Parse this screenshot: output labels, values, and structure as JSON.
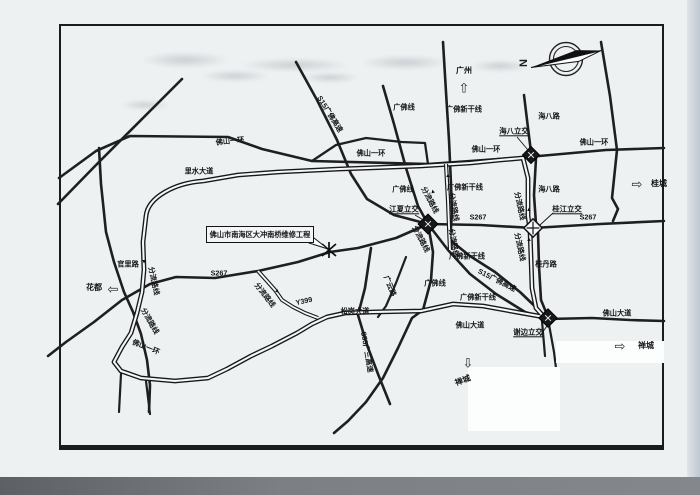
{
  "map": {
    "callout": {
      "text": "佛山市南海区大冲南桥维修工程"
    },
    "compass_label": "N",
    "colors": {
      "paper": "#eef1f2",
      "ink": "#1d1f20"
    },
    "destinations": [
      {
        "label": "广州",
        "direction": "up",
        "x": 464,
        "y": 71,
        "rot": 0,
        "arrow_x": 464,
        "arrow_y": 88
      },
      {
        "label": "桂城",
        "direction": "right",
        "x": 659,
        "y": 184,
        "rot": 0,
        "arrow_x": 637,
        "arrow_y": 184
      },
      {
        "label": "花都",
        "direction": "left",
        "x": 94,
        "y": 288,
        "rot": 0,
        "arrow_x": 113,
        "arrow_y": 289
      },
      {
        "label": "禅城",
        "direction": "down",
        "x": 463,
        "y": 381,
        "rot": -20,
        "arrow_x": 468,
        "arrow_y": 363
      },
      {
        "label": "禅城",
        "direction": "right",
        "x": 646,
        "y": 346,
        "rot": 0,
        "arrow_x": 620,
        "arrow_y": 346
      }
    ],
    "interchanges": [
      {
        "label": "海八立交",
        "x": 514,
        "y": 132
      },
      {
        "label": "江夏立交",
        "x": 404,
        "y": 210
      },
      {
        "label": "桂江立交",
        "x": 567,
        "y": 210
      },
      {
        "label": "谢边立交",
        "x": 528,
        "y": 333
      }
    ],
    "road_labels": [
      {
        "text": "佛山一环",
        "x": 230,
        "y": 141,
        "rot": -6
      },
      {
        "text": "S15广佛高速",
        "x": 330,
        "y": 114,
        "rot": 58
      },
      {
        "text": "广佛线",
        "x": 404,
        "y": 107,
        "rot": 0
      },
      {
        "text": "广佛新干线",
        "x": 464,
        "y": 109,
        "rot": 0
      },
      {
        "text": "海八路",
        "x": 549,
        "y": 116,
        "rot": 0
      },
      {
        "text": "佛山一环",
        "x": 594,
        "y": 142,
        "rot": 0
      },
      {
        "text": "佛山一环",
        "x": 371,
        "y": 153,
        "rot": 0
      },
      {
        "text": "佛山一环",
        "x": 486,
        "y": 149,
        "rot": 0
      },
      {
        "text": "里水大道",
        "x": 199,
        "y": 171,
        "rot": 0
      },
      {
        "text": "广佛线",
        "x": 403,
        "y": 189,
        "rot": 0
      },
      {
        "text": "广佛新干线",
        "x": 465,
        "y": 187,
        "rot": 0
      },
      {
        "text": "海八路",
        "x": 549,
        "y": 189,
        "rot": 0
      },
      {
        "text": "S267",
        "x": 478,
        "y": 217,
        "rot": 0
      },
      {
        "text": "S267",
        "x": 588,
        "y": 217,
        "rot": 0
      },
      {
        "text": "S267",
        "x": 219,
        "y": 273,
        "rot": 0
      },
      {
        "text": "官里路",
        "x": 128,
        "y": 264,
        "rot": 0
      },
      {
        "text": "分流路线",
        "x": 430,
        "y": 200,
        "rot": 62
      },
      {
        "text": "分流路线",
        "x": 454,
        "y": 207,
        "rot": 80
      },
      {
        "text": "分流路线",
        "x": 421,
        "y": 239,
        "rot": 62
      },
      {
        "text": "分流路线",
        "x": 454,
        "y": 243,
        "rot": 80
      },
      {
        "text": "分流路线",
        "x": 520,
        "y": 206,
        "rot": 78
      },
      {
        "text": "分流路线",
        "x": 520,
        "y": 247,
        "rot": 78
      },
      {
        "text": "分流路线",
        "x": 154,
        "y": 281,
        "rot": 78
      },
      {
        "text": "分流路线",
        "x": 150,
        "y": 321,
        "rot": 60
      },
      {
        "text": "分流路线",
        "x": 265,
        "y": 295,
        "rot": 52
      },
      {
        "text": "桂丹路",
        "x": 546,
        "y": 264,
        "rot": 0
      },
      {
        "text": "广佛新干线",
        "x": 467,
        "y": 256,
        "rot": 0
      },
      {
        "text": "S15广佛高速",
        "x": 497,
        "y": 280,
        "rot": 27
      },
      {
        "text": "广佛新干线",
        "x": 478,
        "y": 297,
        "rot": 0
      },
      {
        "text": "广云路",
        "x": 390,
        "y": 286,
        "rot": 68
      },
      {
        "text": "广佛线",
        "x": 435,
        "y": 283,
        "rot": 0
      },
      {
        "text": "松岗大道",
        "x": 355,
        "y": 311,
        "rot": 0
      },
      {
        "text": "Y399",
        "x": 304,
        "y": 301,
        "rot": -12
      },
      {
        "text": "S55广三高速",
        "x": 367,
        "y": 352,
        "rot": 80
      },
      {
        "text": "佛山大道",
        "x": 470,
        "y": 325,
        "rot": 0
      },
      {
        "text": "佛山大道",
        "x": 617,
        "y": 313,
        "rot": 0
      },
      {
        "text": "佛山一环",
        "x": 146,
        "y": 347,
        "rot": 22
      }
    ],
    "flow_arrows": [
      {
        "x": 433,
        "y": 192,
        "rot": -15
      },
      {
        "x": 448,
        "y": 176,
        "rot": 0
      },
      {
        "x": 529,
        "y": 210,
        "rot": 0
      },
      {
        "x": 529,
        "y": 240,
        "rot": 0
      },
      {
        "x": 144,
        "y": 261,
        "rot": 180
      },
      {
        "x": 277,
        "y": 291,
        "rot": 130
      }
    ]
  }
}
